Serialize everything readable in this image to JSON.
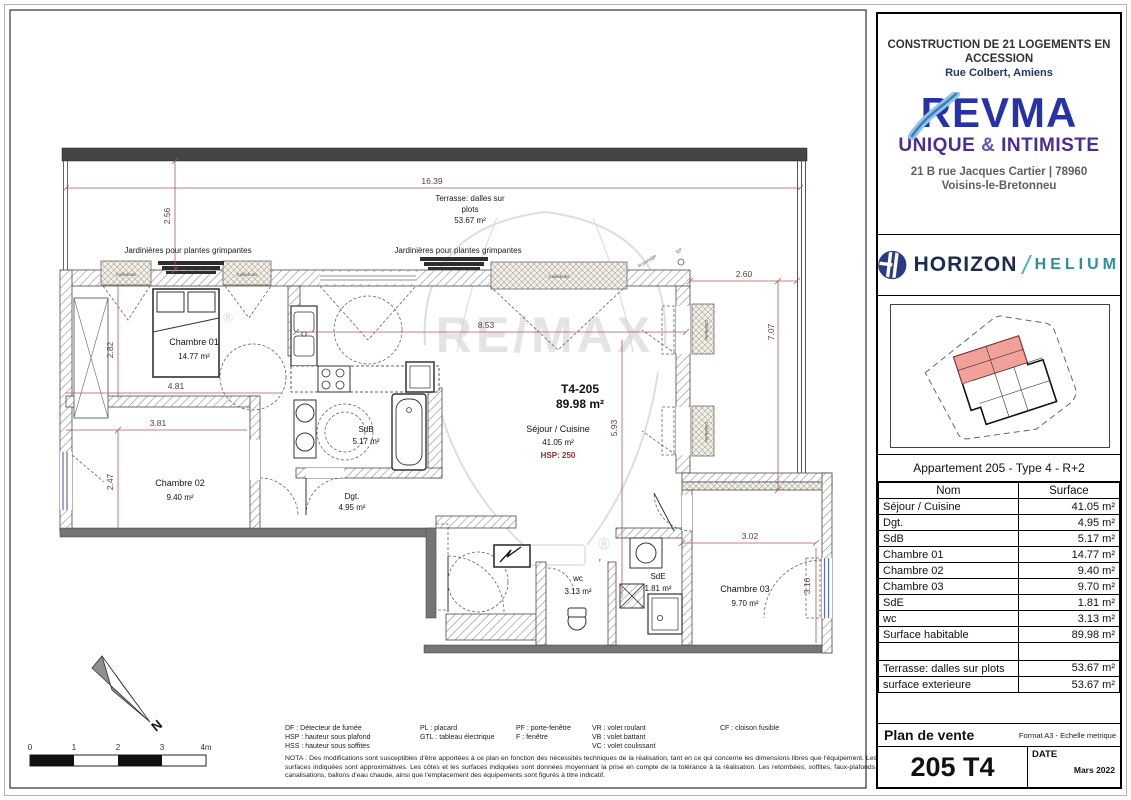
{
  "page": {
    "watermark": "RE/MAX",
    "reg": "®"
  },
  "project": {
    "title_line1": "CONSTRUCTION DE 21 LOGEMENTS EN",
    "title_line2": "ACCESSION",
    "address": "Rue Colbert, Amiens"
  },
  "revma": {
    "name": "REVMA",
    "tagline_unique": "UNIQUE ",
    "tagline_amp": "&",
    "tagline_intimiste": " INTIMISTE",
    "address_line1": "21 B rue Jacques Cartier | 78960",
    "address_line2": "Voisins-le-Bretonneu"
  },
  "horizon": {
    "brand_left": "HORIZON",
    "slash": "/",
    "brand_right": "HELIUM"
  },
  "apartment_header": "Appartement 205 - Type 4 - R+2",
  "table": {
    "col_name": "Nom",
    "col_surface": "Surface",
    "rows": [
      {
        "name": "Séjour / Cuisine",
        "surface": "41.05 m²"
      },
      {
        "name": "Dgt.",
        "surface": "4.95 m²"
      },
      {
        "name": "SdB",
        "surface": "5.17 m²"
      },
      {
        "name": "Chambre 01",
        "surface": "14.77 m²"
      },
      {
        "name": "Chambre 02",
        "surface": "9.40 m²"
      },
      {
        "name": "Chambre 03",
        "surface": "9.70 m²"
      },
      {
        "name": "SdE",
        "surface": "1.81 m²"
      },
      {
        "name": "wc",
        "surface": "3.13 m²"
      },
      {
        "name": "Surface habitable",
        "surface": "89.98 m²"
      },
      {
        "name": "",
        "surface": ""
      },
      {
        "name": "Terrasse: dalles sur plots",
        "surface": "53.67 m²"
      },
      {
        "name": "surface exterieure",
        "surface": "53.67 m²"
      }
    ]
  },
  "titleblock": {
    "doc_type": "Plan de vente",
    "format_note": "Format A3 - Echelle metrique",
    "unit": "205 T4",
    "date_label": "DATE",
    "date_value": "Mars 2022"
  },
  "plan": {
    "unit_code": "T4-205",
    "unit_area": "89.98 m²",
    "sejour_name": "Séjour / Cuisine",
    "sejour_area": "41.05 m²",
    "hsp": "HSP: 250",
    "terrace_line1": "Terrasse: dalles sur",
    "terrace_line2": "plots",
    "terrace_area": "53.67 m²",
    "jardinieres": "Jardinières pour plantes grimpantes",
    "caillebotis": "Caillebotis",
    "rooms": [
      {
        "name": "Chambre 01",
        "area": "14.77 m²"
      },
      {
        "name": "Chambre 02",
        "area": "9.40 m²"
      },
      {
        "name": "Chambre 03",
        "area": "9.70 m²"
      },
      {
        "name": "SdB",
        "area": "5.17 m²"
      },
      {
        "name": "Dgt.",
        "area": "4.95 m²"
      },
      {
        "name": "wc",
        "area": "3.13 m²"
      },
      {
        "name": "SdE",
        "area": "1.81 m²"
      }
    ],
    "dims": {
      "d1639": "16.39",
      "d256": "2.56",
      "d853": "8.53",
      "d260": "2.60",
      "d707": "7.07",
      "d593": "5.93",
      "d282": "2.82",
      "d481": "4.81",
      "d381": "3.81",
      "d247": "2.47",
      "d302": "3.02",
      "d316": "3.16"
    },
    "annotations": {
      "puisage": "R.puisage",
      "ep": "EP",
      "window_f": "F"
    },
    "north_label": "N",
    "scalebar": {
      "t0": "0",
      "t1": "1",
      "t2": "2",
      "t3": "3",
      "t4": "4m"
    }
  },
  "legend": {
    "col1": [
      "DF   : Détecteur de fumée",
      "HSP : hauteur sous plafond",
      "HSS : hauteur sous soffites"
    ],
    "col2": [
      "PL : placard",
      "GTL : tableau électrique"
    ],
    "col3": [
      "PF : porte-fenêtre",
      "F    : fenêtre"
    ],
    "col4": [
      "VR : volet roulant",
      "VB : volet battant",
      "VC : volet coulissant"
    ],
    "col5": [
      "CF : cloison fusible"
    ],
    "nota": "NOTA : Des modifications sont susceptibles d'être apportées à ce plan en fonction des nécessités techniques de la réalisation, tant en ce qui concerne les dimensions libres que l'équipement. Les surfaces indiquées sont approximatives. Les côtes et les surfaces indiquées sont données moyennant la prise en compte de la tolérance à la réalisation. Les retombées, soffites, faux-plafonds, canalisations, ballons d'eau chaude, ainsi que l'emplacement des équipements sont figurés à titre indicatif."
  }
}
